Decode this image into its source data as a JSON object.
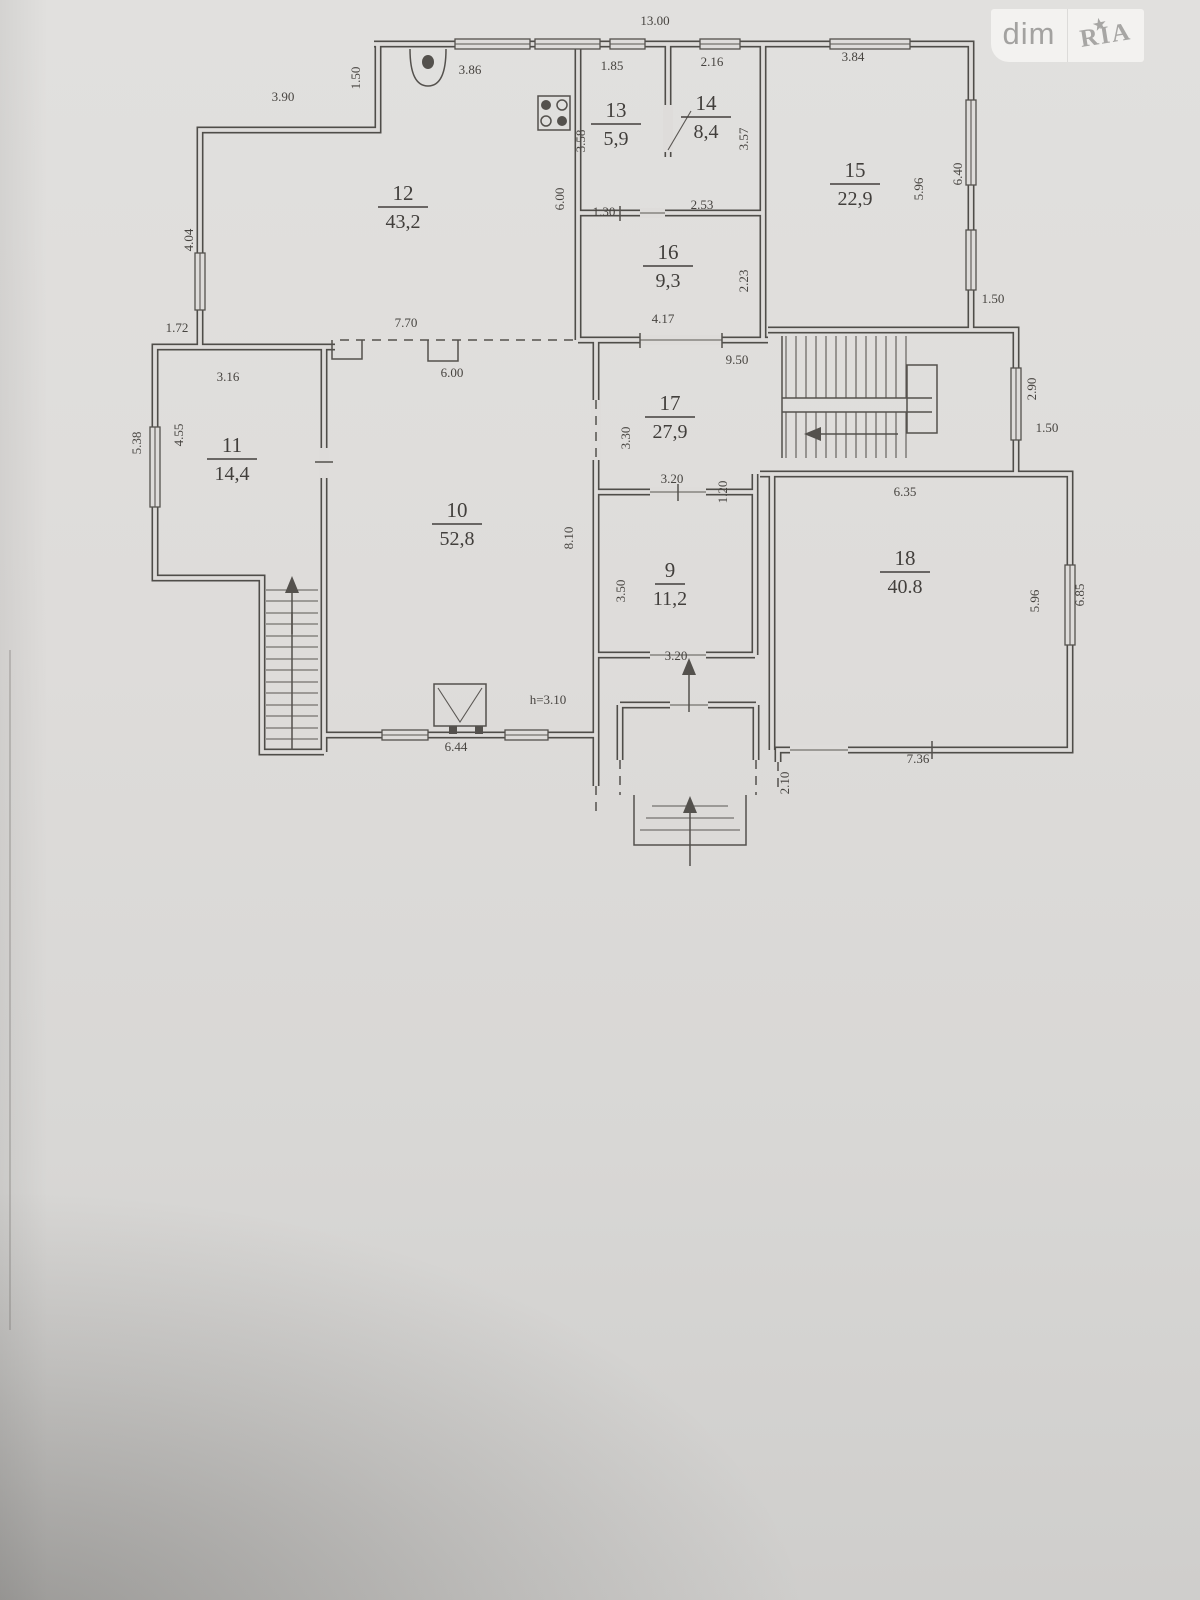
{
  "watermark": {
    "left": "dim",
    "right": "RIA",
    "star": "★"
  },
  "colors": {
    "ink": "#4f4d49",
    "paper": "#dedcda",
    "watermark_bg": "#f2f1ef",
    "watermark_text": "#a3a2a0"
  },
  "plan": {
    "rooms": [
      {
        "number": "12",
        "area": "43,2",
        "x": 403,
        "y": 200
      },
      {
        "number": "13",
        "area": "5,9",
        "x": 616,
        "y": 117
      },
      {
        "number": "14",
        "area": "8,4",
        "x": 706,
        "y": 110
      },
      {
        "number": "15",
        "area": "22,9",
        "x": 855,
        "y": 177
      },
      {
        "number": "16",
        "area": "9,3",
        "x": 668,
        "y": 259
      },
      {
        "number": "11",
        "area": "14,4",
        "x": 232,
        "y": 452
      },
      {
        "number": "17",
        "area": "27,9",
        "x": 670,
        "y": 410
      },
      {
        "number": "10",
        "area": "52,8",
        "x": 457,
        "y": 517
      },
      {
        "number": "9",
        "area": "11,2",
        "x": 670,
        "y": 577
      },
      {
        "number": "18",
        "area": "40.8",
        "x": 905,
        "y": 565
      }
    ],
    "dimensions": [
      {
        "text": "13.00",
        "x": 655,
        "y": 25,
        "rot": 0
      },
      {
        "text": "3.90",
        "x": 283,
        "y": 101,
        "rot": 0
      },
      {
        "text": "1.50",
        "x": 360,
        "y": 78,
        "rot": -90
      },
      {
        "text": "3.86",
        "x": 470,
        "y": 74,
        "rot": 0
      },
      {
        "text": "1.85",
        "x": 612,
        "y": 70,
        "rot": 0
      },
      {
        "text": "2.16",
        "x": 712,
        "y": 66,
        "rot": 0
      },
      {
        "text": "3.84",
        "x": 853,
        "y": 61,
        "rot": 0
      },
      {
        "text": "3.58",
        "x": 585,
        "y": 141,
        "rot": -90
      },
      {
        "text": "3.57",
        "x": 748,
        "y": 139,
        "rot": -90
      },
      {
        "text": "5.96",
        "x": 923,
        "y": 189,
        "rot": -90
      },
      {
        "text": "6.40",
        "x": 962,
        "y": 174,
        "rot": -90
      },
      {
        "text": "6.00",
        "x": 564,
        "y": 199,
        "rot": -90
      },
      {
        "text": "4.04",
        "x": 193,
        "y": 240,
        "rot": -90
      },
      {
        "text": "1.30",
        "x": 604,
        "y": 216,
        "rot": 0
      },
      {
        "text": "2.53",
        "x": 702,
        "y": 209,
        "rot": 0
      },
      {
        "text": "2.23",
        "x": 748,
        "y": 281,
        "rot": -90
      },
      {
        "text": "4.17",
        "x": 663,
        "y": 323,
        "rot": 0
      },
      {
        "text": "1.50",
        "x": 993,
        "y": 303,
        "rot": 0
      },
      {
        "text": "1.72",
        "x": 177,
        "y": 332,
        "rot": 0
      },
      {
        "text": "7.70",
        "x": 406,
        "y": 327,
        "rot": 0
      },
      {
        "text": "6.00",
        "x": 452,
        "y": 377,
        "rot": 0
      },
      {
        "text": "9.50",
        "x": 737,
        "y": 364,
        "rot": 0
      },
      {
        "text": "3.16",
        "x": 228,
        "y": 381,
        "rot": 0
      },
      {
        "text": "2.90",
        "x": 1036,
        "y": 389,
        "rot": -90
      },
      {
        "text": "1.50",
        "x": 1047,
        "y": 432,
        "rot": 0
      },
      {
        "text": "5.38",
        "x": 141,
        "y": 443,
        "rot": -90
      },
      {
        "text": "4.55",
        "x": 183,
        "y": 435,
        "rot": -90
      },
      {
        "text": "3.30",
        "x": 630,
        "y": 438,
        "rot": -90
      },
      {
        "text": "3.20",
        "x": 672,
        "y": 483,
        "rot": 0
      },
      {
        "text": "1.20",
        "x": 727,
        "y": 492,
        "rot": -90
      },
      {
        "text": "6.35",
        "x": 905,
        "y": 496,
        "rot": 0
      },
      {
        "text": "8.10",
        "x": 573,
        "y": 538,
        "rot": -90
      },
      {
        "text": "3.50",
        "x": 625,
        "y": 591,
        "rot": -90
      },
      {
        "text": "5.96",
        "x": 1039,
        "y": 601,
        "rot": -90
      },
      {
        "text": "6.85",
        "x": 1084,
        "y": 595,
        "rot": -90
      },
      {
        "text": "3.20",
        "x": 676,
        "y": 660,
        "rot": 0
      },
      {
        "text": "h=3.10",
        "x": 548,
        "y": 704,
        "rot": 0
      },
      {
        "text": "6.44",
        "x": 456,
        "y": 751,
        "rot": 0
      },
      {
        "text": "7.36",
        "x": 918,
        "y": 763,
        "rot": 0
      },
      {
        "text": "2.10",
        "x": 789,
        "y": 783,
        "rot": -90
      }
    ],
    "icons": [
      "sink-icon",
      "gas-stove-icon",
      "fireplace-icon",
      "staircase-up-arrow-icon",
      "staircase-direction-arrow-icon",
      "entrance-up-arrow-icon",
      "inner-entrance-arrow-icon",
      "star-icon"
    ]
  }
}
